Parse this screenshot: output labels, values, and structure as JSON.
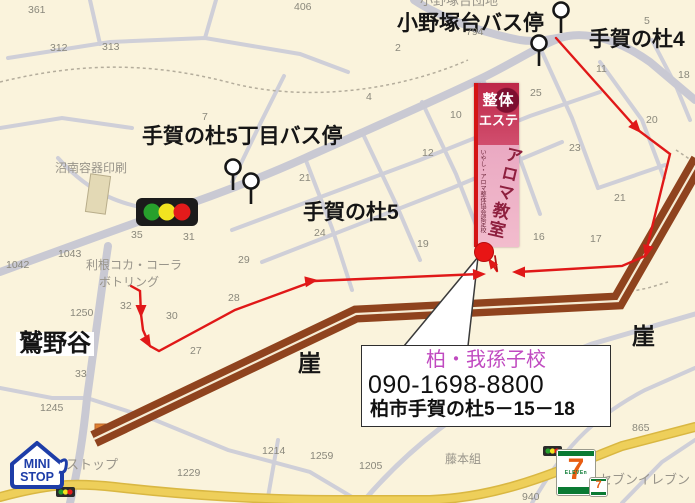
{
  "colors": {
    "background": "#faf3dc",
    "road_grey": "#cfcfd8",
    "road_yellow": "#eecf5a",
    "cliff_brown": "#8f431e",
    "route_red": "#e01818",
    "dot_red": "#e81515",
    "callout_name_magenta": "#c04ac0",
    "banner_crimson": "#bd2748",
    "banner_pink": "#eaa9c2",
    "ministop_blue": "#1d3da8",
    "seven_green": "#0a7a33",
    "seven_orange": "#e85d12"
  },
  "callout": {
    "school_name": "柏・我孫子校",
    "phone": "090-1698-8800",
    "address": "柏市手賀の杜5－15－18"
  },
  "banner": {
    "line1": "整体",
    "line2": "エステ",
    "main": "アロマ教室",
    "side": "いやし・アロマ整体協会認定校"
  },
  "logos": {
    "ministop": {
      "line1": "MINI",
      "line2": "STOP"
    },
    "seveneleven": {
      "seven": "7",
      "eleven": "ELEVEn",
      "seven_small": "7"
    }
  },
  "map": {
    "labels": [
      {
        "text": "小野塚台バス停",
        "x": 397,
        "y": 13,
        "size": 21,
        "bold": true
      },
      {
        "text": "手賀の杜4",
        "x": 589,
        "y": 29,
        "size": 21,
        "bold": true
      },
      {
        "text": "手賀の杜5丁目バス停",
        "x": 142,
        "y": 126,
        "size": 21,
        "bold": true
      },
      {
        "text": "手賀の杜5",
        "x": 303,
        "y": 202,
        "size": 21,
        "bold": true
      },
      {
        "text": "鷲野谷",
        "x": 16,
        "y": 332,
        "size": 24,
        "bold": true,
        "bg": true
      },
      {
        "text": "崖",
        "x": 298,
        "y": 352,
        "size": 23,
        "bold": true
      },
      {
        "text": "崖",
        "x": 632,
        "y": 325,
        "size": 23,
        "bold": true
      },
      {
        "text": "沼南容器印刷",
        "x": 55,
        "y": 162,
        "size": 12,
        "grey": true
      },
      {
        "text": "利根コカ・コーラ",
        "x": 86,
        "y": 259,
        "size": 12,
        "grey": true
      },
      {
        "text": "ボトリング",
        "x": 99,
        "y": 276,
        "size": 12,
        "grey": true
      },
      {
        "text": "ストップ",
        "x": 66,
        "y": 458,
        "size": 13,
        "grey": true
      },
      {
        "text": "セブンイレブン",
        "x": 599,
        "y": 473,
        "size": 13,
        "grey": true
      },
      {
        "text": "藤本組",
        "x": 445,
        "y": 453,
        "size": 12,
        "grey": true
      },
      {
        "text": "小野塚台団地",
        "x": 420,
        "y": -6,
        "size": 13,
        "grey": true
      }
    ],
    "numbers": [
      {
        "t": "361",
        "x": 28,
        "y": 5
      },
      {
        "t": "312",
        "x": 50,
        "y": 43
      },
      {
        "t": "313",
        "x": 102,
        "y": 42
      },
      {
        "t": "406",
        "x": 294,
        "y": 2
      },
      {
        "t": "794",
        "x": 466,
        "y": 27
      },
      {
        "t": "2",
        "x": 395,
        "y": 43
      },
      {
        "t": "4",
        "x": 366,
        "y": 92
      },
      {
        "t": "10",
        "x": 450,
        "y": 110
      },
      {
        "t": "12",
        "x": 422,
        "y": 148
      },
      {
        "t": "25",
        "x": 530,
        "y": 88
      },
      {
        "t": "23",
        "x": 569,
        "y": 143
      },
      {
        "t": "11",
        "x": 596,
        "y": 64
      },
      {
        "t": "18",
        "x": 678,
        "y": 70
      },
      {
        "t": "20",
        "x": 646,
        "y": 115
      },
      {
        "t": "21",
        "x": 299,
        "y": 173
      },
      {
        "t": "21",
        "x": 614,
        "y": 193
      },
      {
        "t": "7",
        "x": 202,
        "y": 112
      },
      {
        "t": "5",
        "x": 644,
        "y": 16
      },
      {
        "t": "19",
        "x": 417,
        "y": 239
      },
      {
        "t": "16",
        "x": 533,
        "y": 232
      },
      {
        "t": "17",
        "x": 590,
        "y": 234
      },
      {
        "t": "24",
        "x": 314,
        "y": 228
      },
      {
        "t": "35",
        "x": 131,
        "y": 230
      },
      {
        "t": "31",
        "x": 183,
        "y": 232
      },
      {
        "t": "29",
        "x": 238,
        "y": 255
      },
      {
        "t": "28",
        "x": 228,
        "y": 293
      },
      {
        "t": "27",
        "x": 190,
        "y": 346
      },
      {
        "t": "32",
        "x": 120,
        "y": 301
      },
      {
        "t": "30",
        "x": 166,
        "y": 311
      },
      {
        "t": "33",
        "x": 75,
        "y": 369
      },
      {
        "t": "1042",
        "x": 6,
        "y": 260
      },
      {
        "t": "1043",
        "x": 58,
        "y": 249
      },
      {
        "t": "1250",
        "x": 70,
        "y": 308
      },
      {
        "t": "1245",
        "x": 40,
        "y": 403
      },
      {
        "t": "1229",
        "x": 177,
        "y": 468
      },
      {
        "t": "1214",
        "x": 262,
        "y": 446
      },
      {
        "t": "1259",
        "x": 310,
        "y": 451
      },
      {
        "t": "1205",
        "x": 359,
        "y": 461
      },
      {
        "t": "865",
        "x": 632,
        "y": 423
      },
      {
        "t": "940",
        "x": 522,
        "y": 492
      }
    ]
  }
}
